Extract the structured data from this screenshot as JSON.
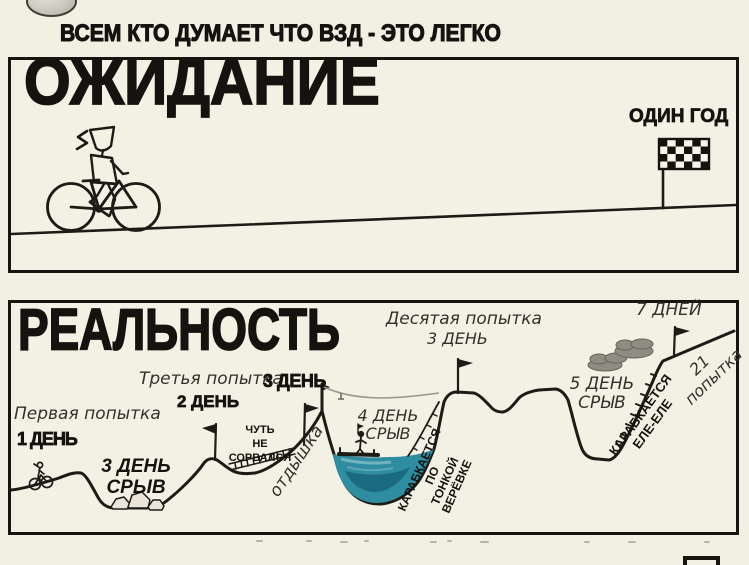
{
  "colors": {
    "paper": "#f2efe3",
    "panel": "#f3f0e4",
    "ink": "#1d1b16",
    "water": "#2f8da1",
    "water_dark": "#16657b",
    "water_light": "#79b8c2",
    "cloud": "#8f8d82"
  },
  "header": {
    "title": "ВСЕМ КТО ДУМАЕТ ЧТО ВЗД - ЭТО ЛЕГКО"
  },
  "expectation": {
    "heading": "ОЖИДАНИЕ",
    "finish_label": "ОДИН ГОД"
  },
  "reality": {
    "heading": "РЕАЛЬНОСТЬ",
    "labels": {
      "attempt_first": "Первая попытка",
      "day_1": "1 ДЕНЬ",
      "fail_day3": "3 ДЕНЬ\nСРЫВ",
      "attempt_third": "Третья попытка",
      "day_3_bold": "3 ДЕНЬ",
      "day_2": "2 ДЕНЬ",
      "almost_fell": "ЧУТЬ\nНЕ СОРВАЛСЯ",
      "breather": "отдышка",
      "attempt_tenth": "Десятая попытка",
      "day_3_hand": "3 ДЕНЬ",
      "fail_day4": "4 ДЕНЬ\nСРЫВ",
      "rope_climb": "КАРАБКАЕТСЯ ПО\nТОНКОЙ ВЕРЁВКЕ",
      "fail_day5": "5 ДЕНЬ\nСРЫВ",
      "barely_climb": "КАРАБКАЕТСЯ\nЕЛЕ-ЕЛЕ",
      "attempt_21": "21\nпопытка",
      "days_7": "7 ДНЕЙ"
    }
  },
  "icons": {
    "rider": "cyclist-icon",
    "finish": "checkered-flag-icon",
    "milestone": "pennant-flag-icon",
    "bridge": "rope-ladder-icon",
    "raft": "raft-icon",
    "weather": "cloud-icon",
    "debris": "rock-icon",
    "corner_object": "sphere-icon"
  }
}
